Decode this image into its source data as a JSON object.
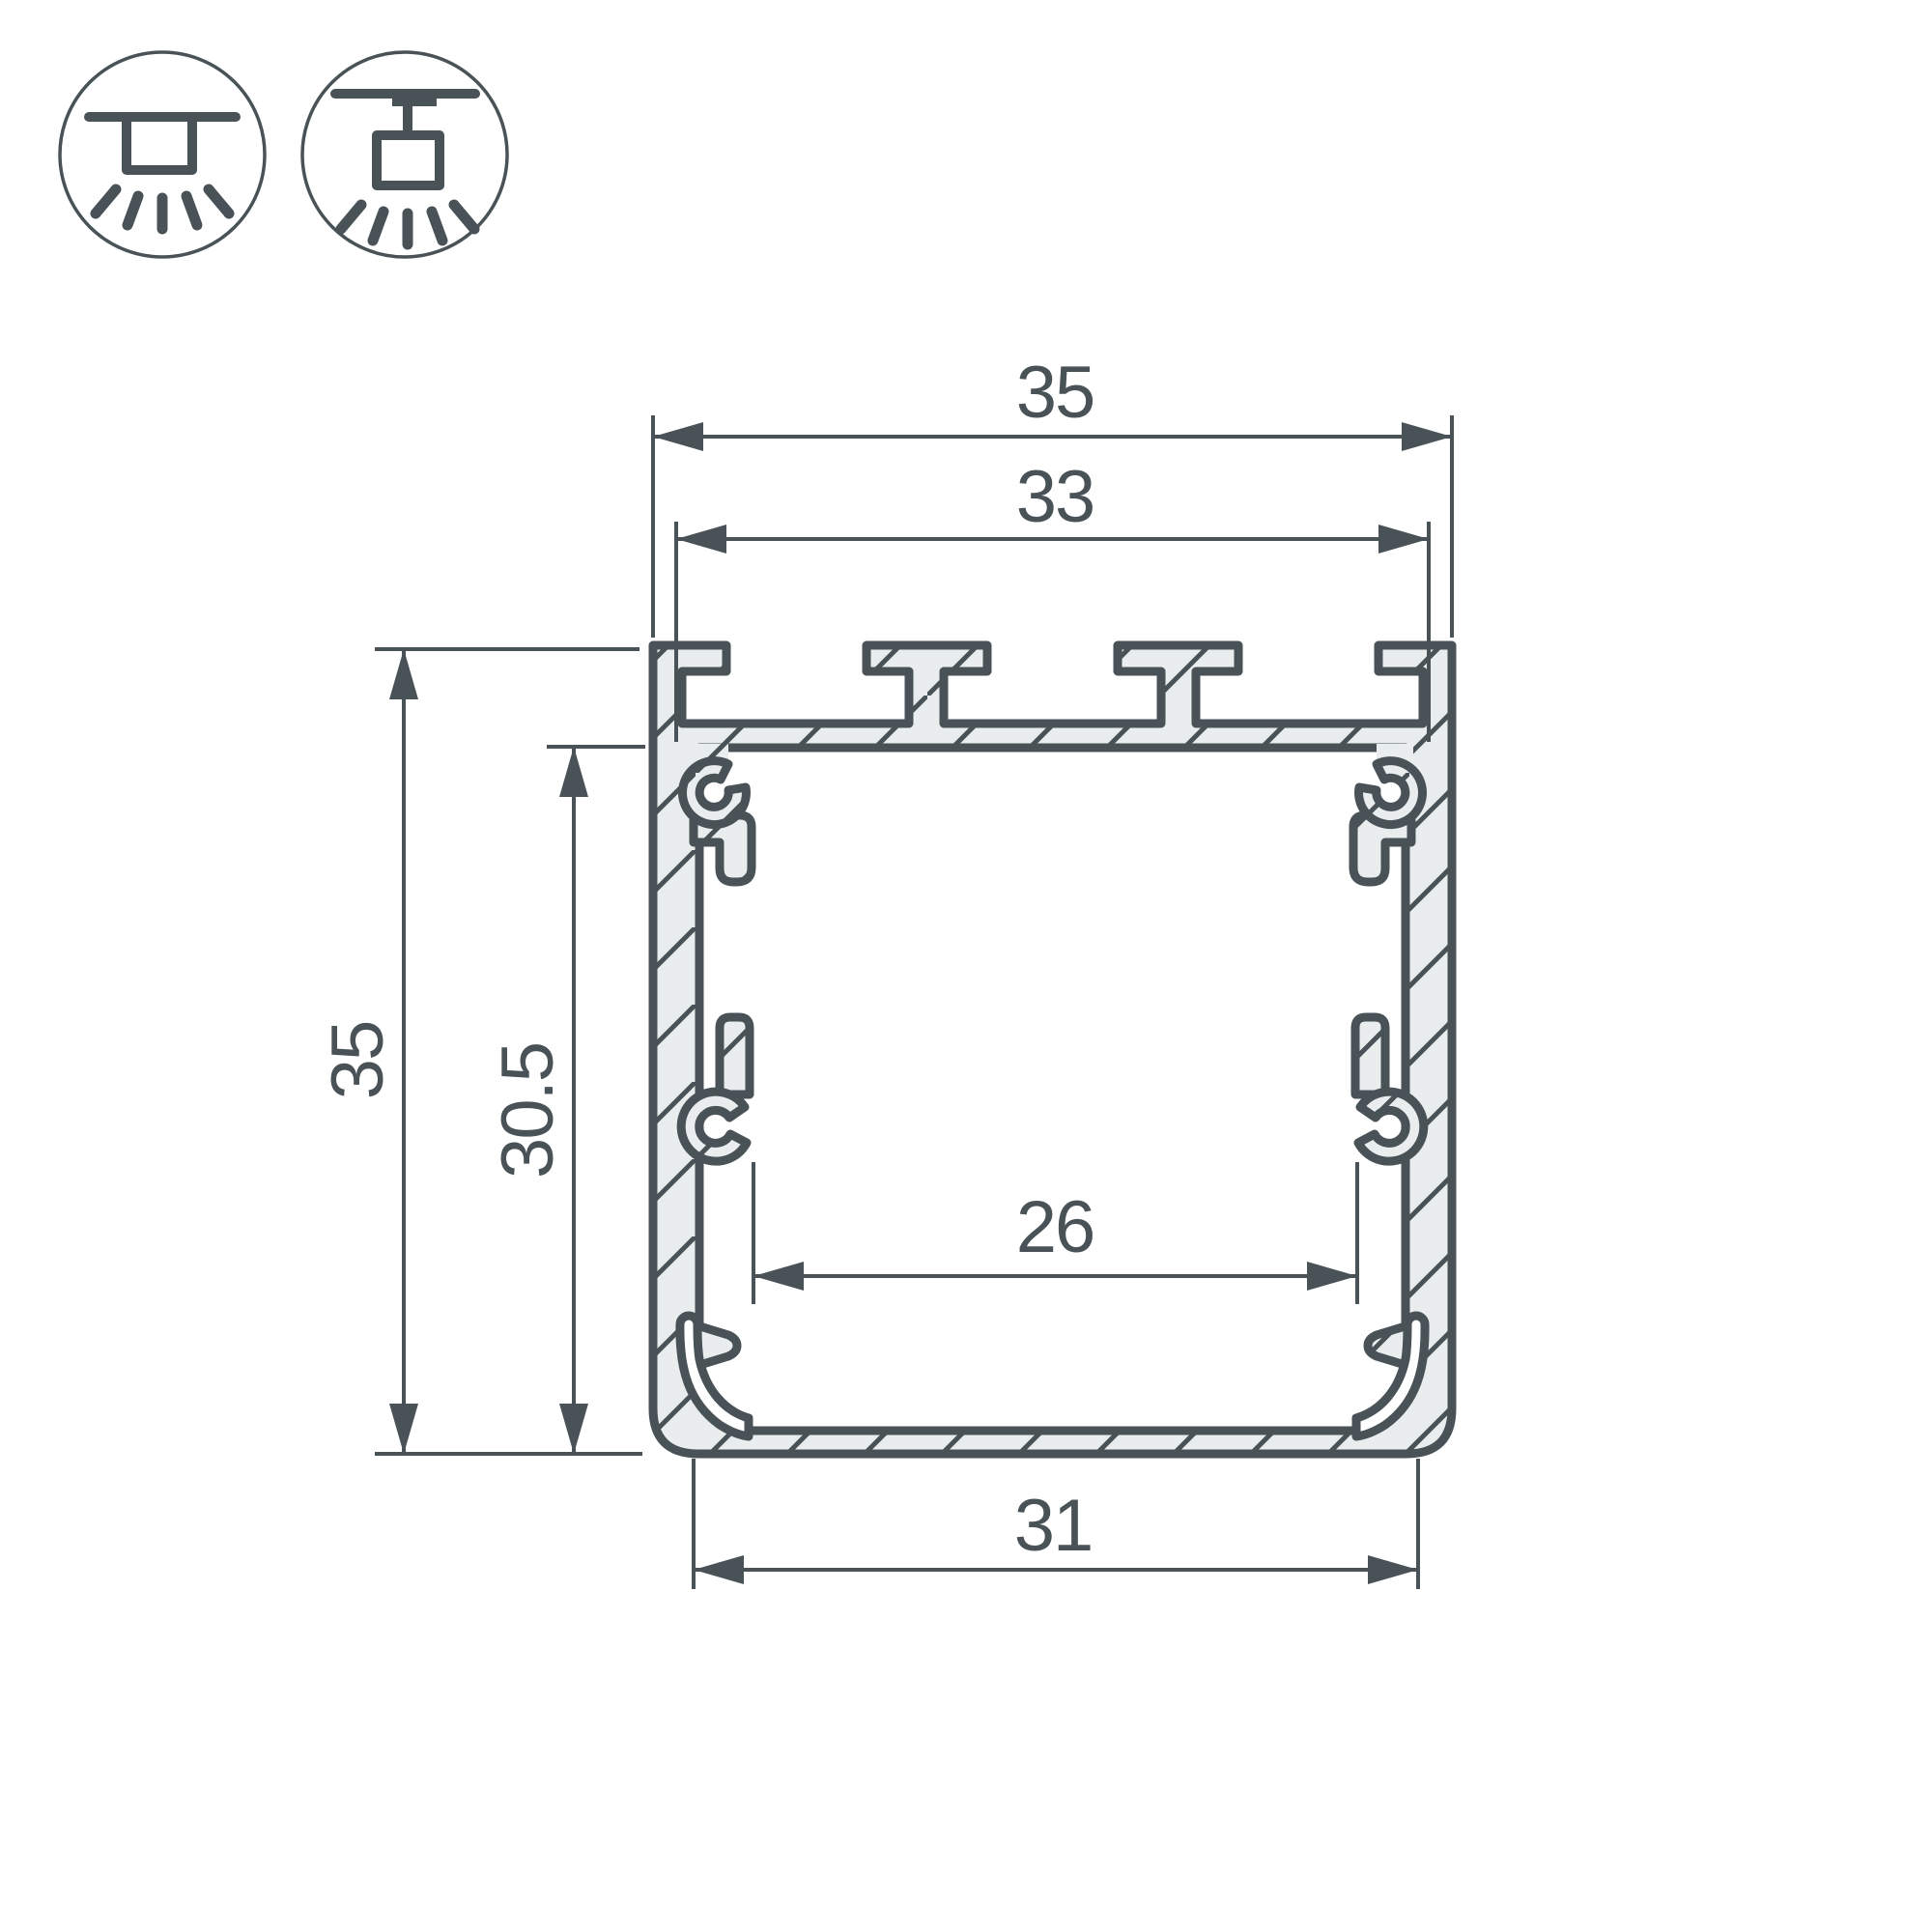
{
  "drawing": {
    "title": "led-profile-cross-section",
    "line_color": "#485257",
    "metal_fill": "#eaedee",
    "background": "#ffffff",
    "dimensions": {
      "outer_width": "35",
      "slot_width": "33",
      "outer_height": "35",
      "inner_height": "30.5",
      "inner_width": "26",
      "bottom_width": "31"
    },
    "icons": [
      {
        "name": "surface-mount-icon"
      },
      {
        "name": "pendant-mount-icon"
      }
    ]
  }
}
